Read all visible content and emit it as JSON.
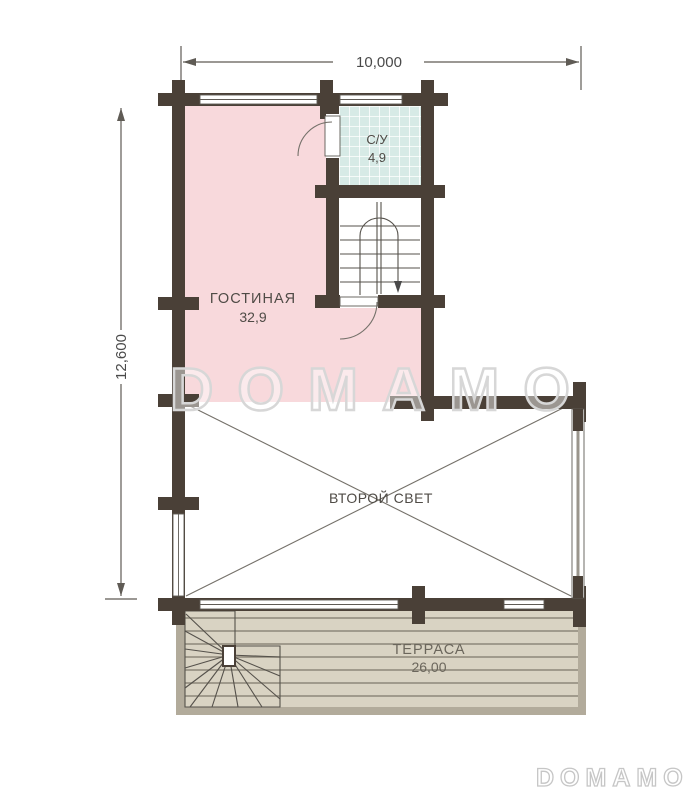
{
  "dimensions": {
    "width_label": "10,000",
    "height_label": "12,600"
  },
  "rooms": {
    "living": {
      "label": "ГОСТИНАЯ",
      "area": "32,9"
    },
    "bathroom": {
      "label": "С/У",
      "area": "4,9"
    },
    "second_light": {
      "label": "ВТОРОЙ СВЕТ"
    },
    "terrace": {
      "label": "ТЕРРАСА",
      "area": "26,00"
    }
  },
  "watermark": {
    "center": "DOMAMO",
    "corner": "DOMAMO"
  },
  "colors": {
    "wall": "#4a4037",
    "living": "#f8d9dc",
    "bathroom_tile": "#d7eae6",
    "terrace": "#d9d3c3",
    "terrace_border": "#b2ab9b",
    "plank_line": "#8d887a",
    "line": "#5f5b55",
    "thin": "#75716a",
    "label": "#4f4b46",
    "terrace_label": "#6b665c",
    "watermark": "#d7d7d7"
  }
}
